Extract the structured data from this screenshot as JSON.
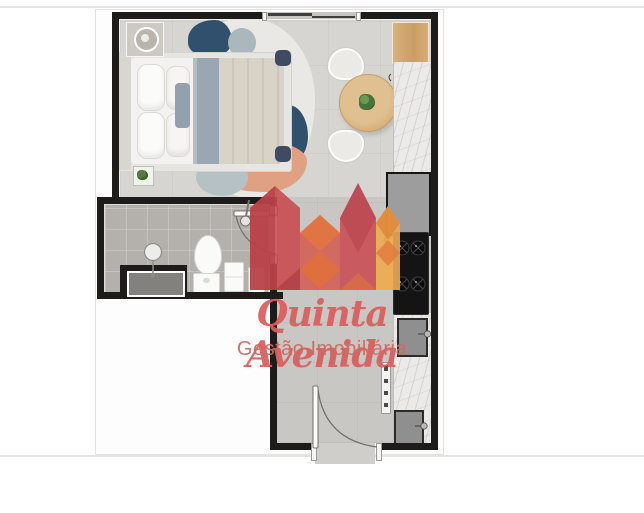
{
  "page": {
    "background": "#ffffff",
    "divider_color": "#e4e4e3"
  },
  "watermark": {
    "brand": "Quinta Avenida",
    "tagline": "Gestão Imobiliária",
    "brand_color": "#db5c5c",
    "tagline_color": "#c96c64",
    "logo_palette": {
      "red": "#c8494f",
      "dark_red": "#ad3a42",
      "salmon": "#d45b52",
      "orange": "#e27540",
      "amber": "#edaa4c"
    }
  },
  "floorplan": {
    "wall_color": "#1d1c1a",
    "bedroom_floor_color": "#d7d5d1",
    "hall_floor_color": "#c9c7c3",
    "bath_floor_color": "#b4b1ad",
    "wood_color": "#d3a877",
    "rug_navy": "#31506e",
    "rug_salmon": "#e0a182",
    "fixtures": [
      "double-bed",
      "nightstand-lamp",
      "area-rug",
      "dining-table",
      "plant",
      "chairs",
      "kitchen-cabinet",
      "counter",
      "fridge",
      "cooktop",
      "sinks",
      "toilet",
      "shower",
      "entry-door",
      "bathroom-door",
      "window"
    ]
  }
}
